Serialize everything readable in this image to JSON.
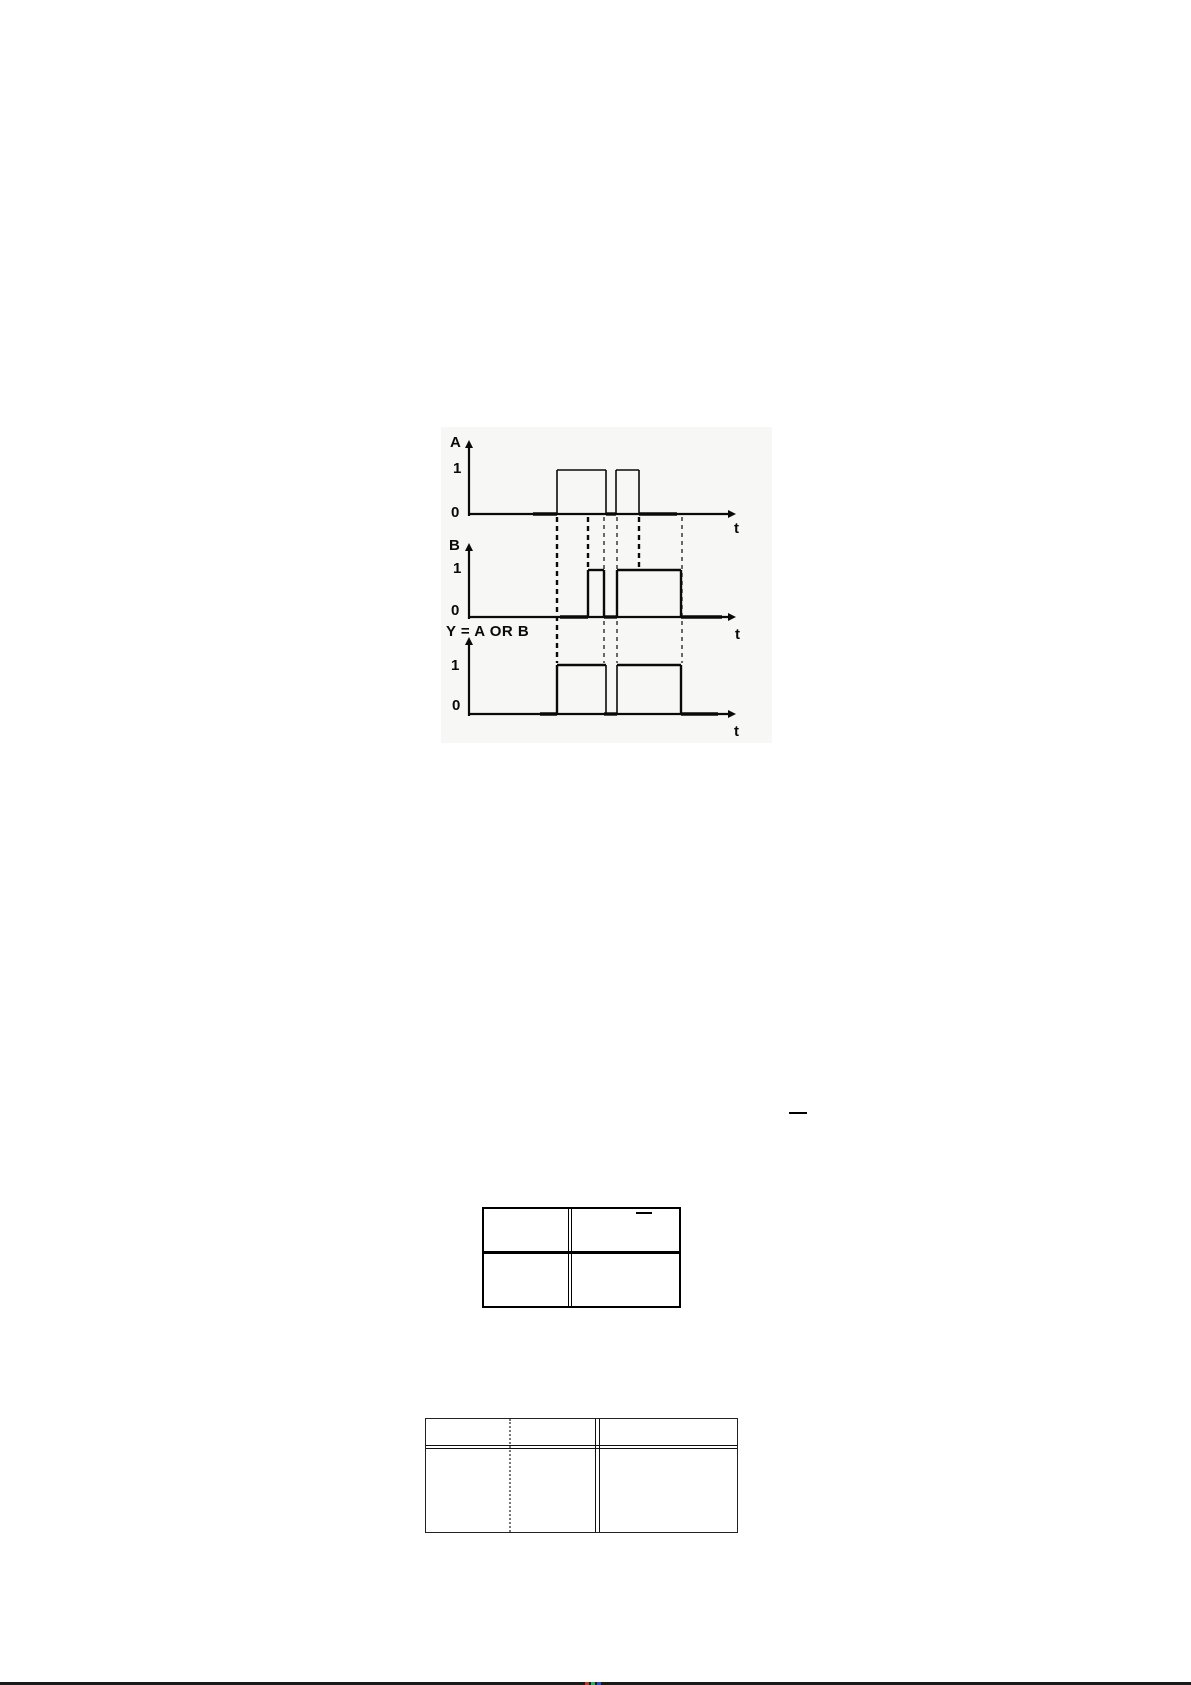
{
  "page": {
    "background": "#ffffff"
  },
  "figure": {
    "title": "OR gate timing diagram",
    "bg": "#f7f7f5",
    "ink": "#0a0a0a",
    "labels": [
      {
        "name": "signal-a-axis-label",
        "text": "A",
        "x": 450,
        "y": 435
      },
      {
        "name": "signal-a-high-tick",
        "text": "1",
        "x": 453,
        "y": 461
      },
      {
        "name": "signal-a-low-tick",
        "text": "0",
        "x": 451,
        "y": 505
      },
      {
        "name": "signal-a-time-label",
        "text": "t",
        "x": 734,
        "y": 521
      },
      {
        "name": "signal-b-axis-label",
        "text": "B",
        "x": 449,
        "y": 538
      },
      {
        "name": "signal-b-high-tick",
        "text": "1",
        "x": 453,
        "y": 561
      },
      {
        "name": "signal-b-low-tick",
        "text": "0",
        "x": 451,
        "y": 603
      },
      {
        "name": "signal-b-time-label",
        "text": "t",
        "x": 735,
        "y": 627
      },
      {
        "name": "output-expression-label",
        "text": "Y = A OR B",
        "x": 446,
        "y": 624
      },
      {
        "name": "signal-y-high-tick",
        "text": "1",
        "x": 451,
        "y": 658
      },
      {
        "name": "signal-y-low-tick",
        "text": "0",
        "x": 452,
        "y": 698
      },
      {
        "name": "signal-y-time-label",
        "text": "t",
        "x": 734,
        "y": 724
      }
    ],
    "signals": [
      {
        "name": "A",
        "low_level": "0",
        "high_level": "1",
        "low_y": 514,
        "high_y": 470,
        "high_intervals_px": [
          [
            557,
            606
          ],
          [
            616,
            639
          ]
        ]
      },
      {
        "name": "B",
        "low_level": "0",
        "high_level": "1",
        "low_y": 617,
        "high_y": 570,
        "high_intervals_px": [
          [
            588,
            604
          ],
          [
            617,
            681
          ]
        ]
      },
      {
        "name": "Y = A OR B",
        "low_level": "0",
        "high_level": "1",
        "low_y": 714,
        "high_y": 665,
        "high_intervals_px": [
          [
            557,
            606
          ],
          [
            617,
            681
          ]
        ]
      }
    ],
    "lines": [
      {
        "x1": 469,
        "y1": 444,
        "x2": 469,
        "y2": 516,
        "w": 2.2
      },
      {
        "x1": 469,
        "y1": 514,
        "x2": 733,
        "y2": 514,
        "w": 2.2
      },
      {
        "x1": 469,
        "y1": 547,
        "x2": 469,
        "y2": 619,
        "w": 2.2
      },
      {
        "x1": 469,
        "y1": 617,
        "x2": 733,
        "y2": 617,
        "w": 2.2
      },
      {
        "x1": 469,
        "y1": 641,
        "x2": 469,
        "y2": 716,
        "w": 2.2
      },
      {
        "x1": 469,
        "y1": 714,
        "x2": 733,
        "y2": 714,
        "w": 2.2
      },
      {
        "x1": 557,
        "y1": 514,
        "x2": 557,
        "y2": 470,
        "w": 1.6
      },
      {
        "x1": 557,
        "y1": 470,
        "x2": 606,
        "y2": 470,
        "w": 1.6
      },
      {
        "x1": 606,
        "y1": 470,
        "x2": 606,
        "y2": 514,
        "w": 1.6
      },
      {
        "x1": 616,
        "y1": 514,
        "x2": 616,
        "y2": 470,
        "w": 1.6
      },
      {
        "x1": 616,
        "y1": 470,
        "x2": 639,
        "y2": 470,
        "w": 1.6
      },
      {
        "x1": 639,
        "y1": 470,
        "x2": 639,
        "y2": 514,
        "w": 1.6
      },
      {
        "x1": 533,
        "y1": 514,
        "x2": 557,
        "y2": 514,
        "w": 3.4
      },
      {
        "x1": 606,
        "y1": 514,
        "x2": 616,
        "y2": 514,
        "w": 3.4
      },
      {
        "x1": 639,
        "y1": 514,
        "x2": 677,
        "y2": 514,
        "w": 3.4
      },
      {
        "x1": 588,
        "y1": 617,
        "x2": 588,
        "y2": 570,
        "w": 2.4
      },
      {
        "x1": 588,
        "y1": 570,
        "x2": 604,
        "y2": 570,
        "w": 2.4
      },
      {
        "x1": 604,
        "y1": 570,
        "x2": 604,
        "y2": 617,
        "w": 2.4
      },
      {
        "x1": 617,
        "y1": 617,
        "x2": 617,
        "y2": 570,
        "w": 2.4
      },
      {
        "x1": 617,
        "y1": 570,
        "x2": 681,
        "y2": 570,
        "w": 2.4
      },
      {
        "x1": 681,
        "y1": 570,
        "x2": 681,
        "y2": 617,
        "w": 2.4
      },
      {
        "x1": 560,
        "y1": 617,
        "x2": 588,
        "y2": 617,
        "w": 3.4
      },
      {
        "x1": 604,
        "y1": 617,
        "x2": 617,
        "y2": 617,
        "w": 3.4
      },
      {
        "x1": 681,
        "y1": 617,
        "x2": 722,
        "y2": 617,
        "w": 3.4
      },
      {
        "x1": 557,
        "y1": 714,
        "x2": 557,
        "y2": 665,
        "w": 2.4
      },
      {
        "x1": 557,
        "y1": 665,
        "x2": 606,
        "y2": 665,
        "w": 2.4
      },
      {
        "x1": 606,
        "y1": 665,
        "x2": 606,
        "y2": 714,
        "w": 1.6
      },
      {
        "x1": 617,
        "y1": 714,
        "x2": 617,
        "y2": 665,
        "w": 1.6
      },
      {
        "x1": 617,
        "y1": 665,
        "x2": 681,
        "y2": 665,
        "w": 2.4
      },
      {
        "x1": 681,
        "y1": 665,
        "x2": 681,
        "y2": 714,
        "w": 2.4
      },
      {
        "x1": 540,
        "y1": 714,
        "x2": 557,
        "y2": 714,
        "w": 3.4
      },
      {
        "x1": 604,
        "y1": 714,
        "x2": 617,
        "y2": 714,
        "w": 3.4
      },
      {
        "x1": 681,
        "y1": 714,
        "x2": 718,
        "y2": 714,
        "w": 3.4
      }
    ],
    "dashes": [
      {
        "x": 557,
        "y1": 517,
        "y2": 663,
        "heavy": true
      },
      {
        "x": 588,
        "y1": 517,
        "y2": 567,
        "heavy": true
      },
      {
        "x": 604,
        "y1": 517,
        "y2": 663,
        "heavy": false
      },
      {
        "x": 617,
        "y1": 517,
        "y2": 663,
        "heavy": false
      },
      {
        "x": 639,
        "y1": 517,
        "y2": 567,
        "heavy": true
      },
      {
        "x": 682,
        "y1": 517,
        "y2": 663,
        "heavy": false
      }
    ],
    "arrows": [
      {
        "x": 469,
        "y": 440,
        "dir": "up"
      },
      {
        "x": 469,
        "y": 543,
        "dir": "up"
      },
      {
        "x": 469,
        "y": 637,
        "dir": "up"
      },
      {
        "x": 736,
        "y": 514,
        "dir": "right"
      },
      {
        "x": 736,
        "y": 617,
        "dir": "right"
      },
      {
        "x": 736,
        "y": 714,
        "dir": "right"
      }
    ]
  },
  "tables": {
    "table1": {
      "rows": 2,
      "cols": 2,
      "cells_empty": true,
      "overline_in_top_right_cell": true
    },
    "table2": {
      "rows": 2,
      "cols": 3,
      "cells_empty": true,
      "header_double_rule": true
    }
  },
  "marks": {
    "stray_overline": true
  },
  "footer": {
    "edge_bar_color": "#1a1a1a",
    "speck_colors": [
      "#c0392b",
      "#27ae60",
      "#2e4bc6"
    ]
  }
}
